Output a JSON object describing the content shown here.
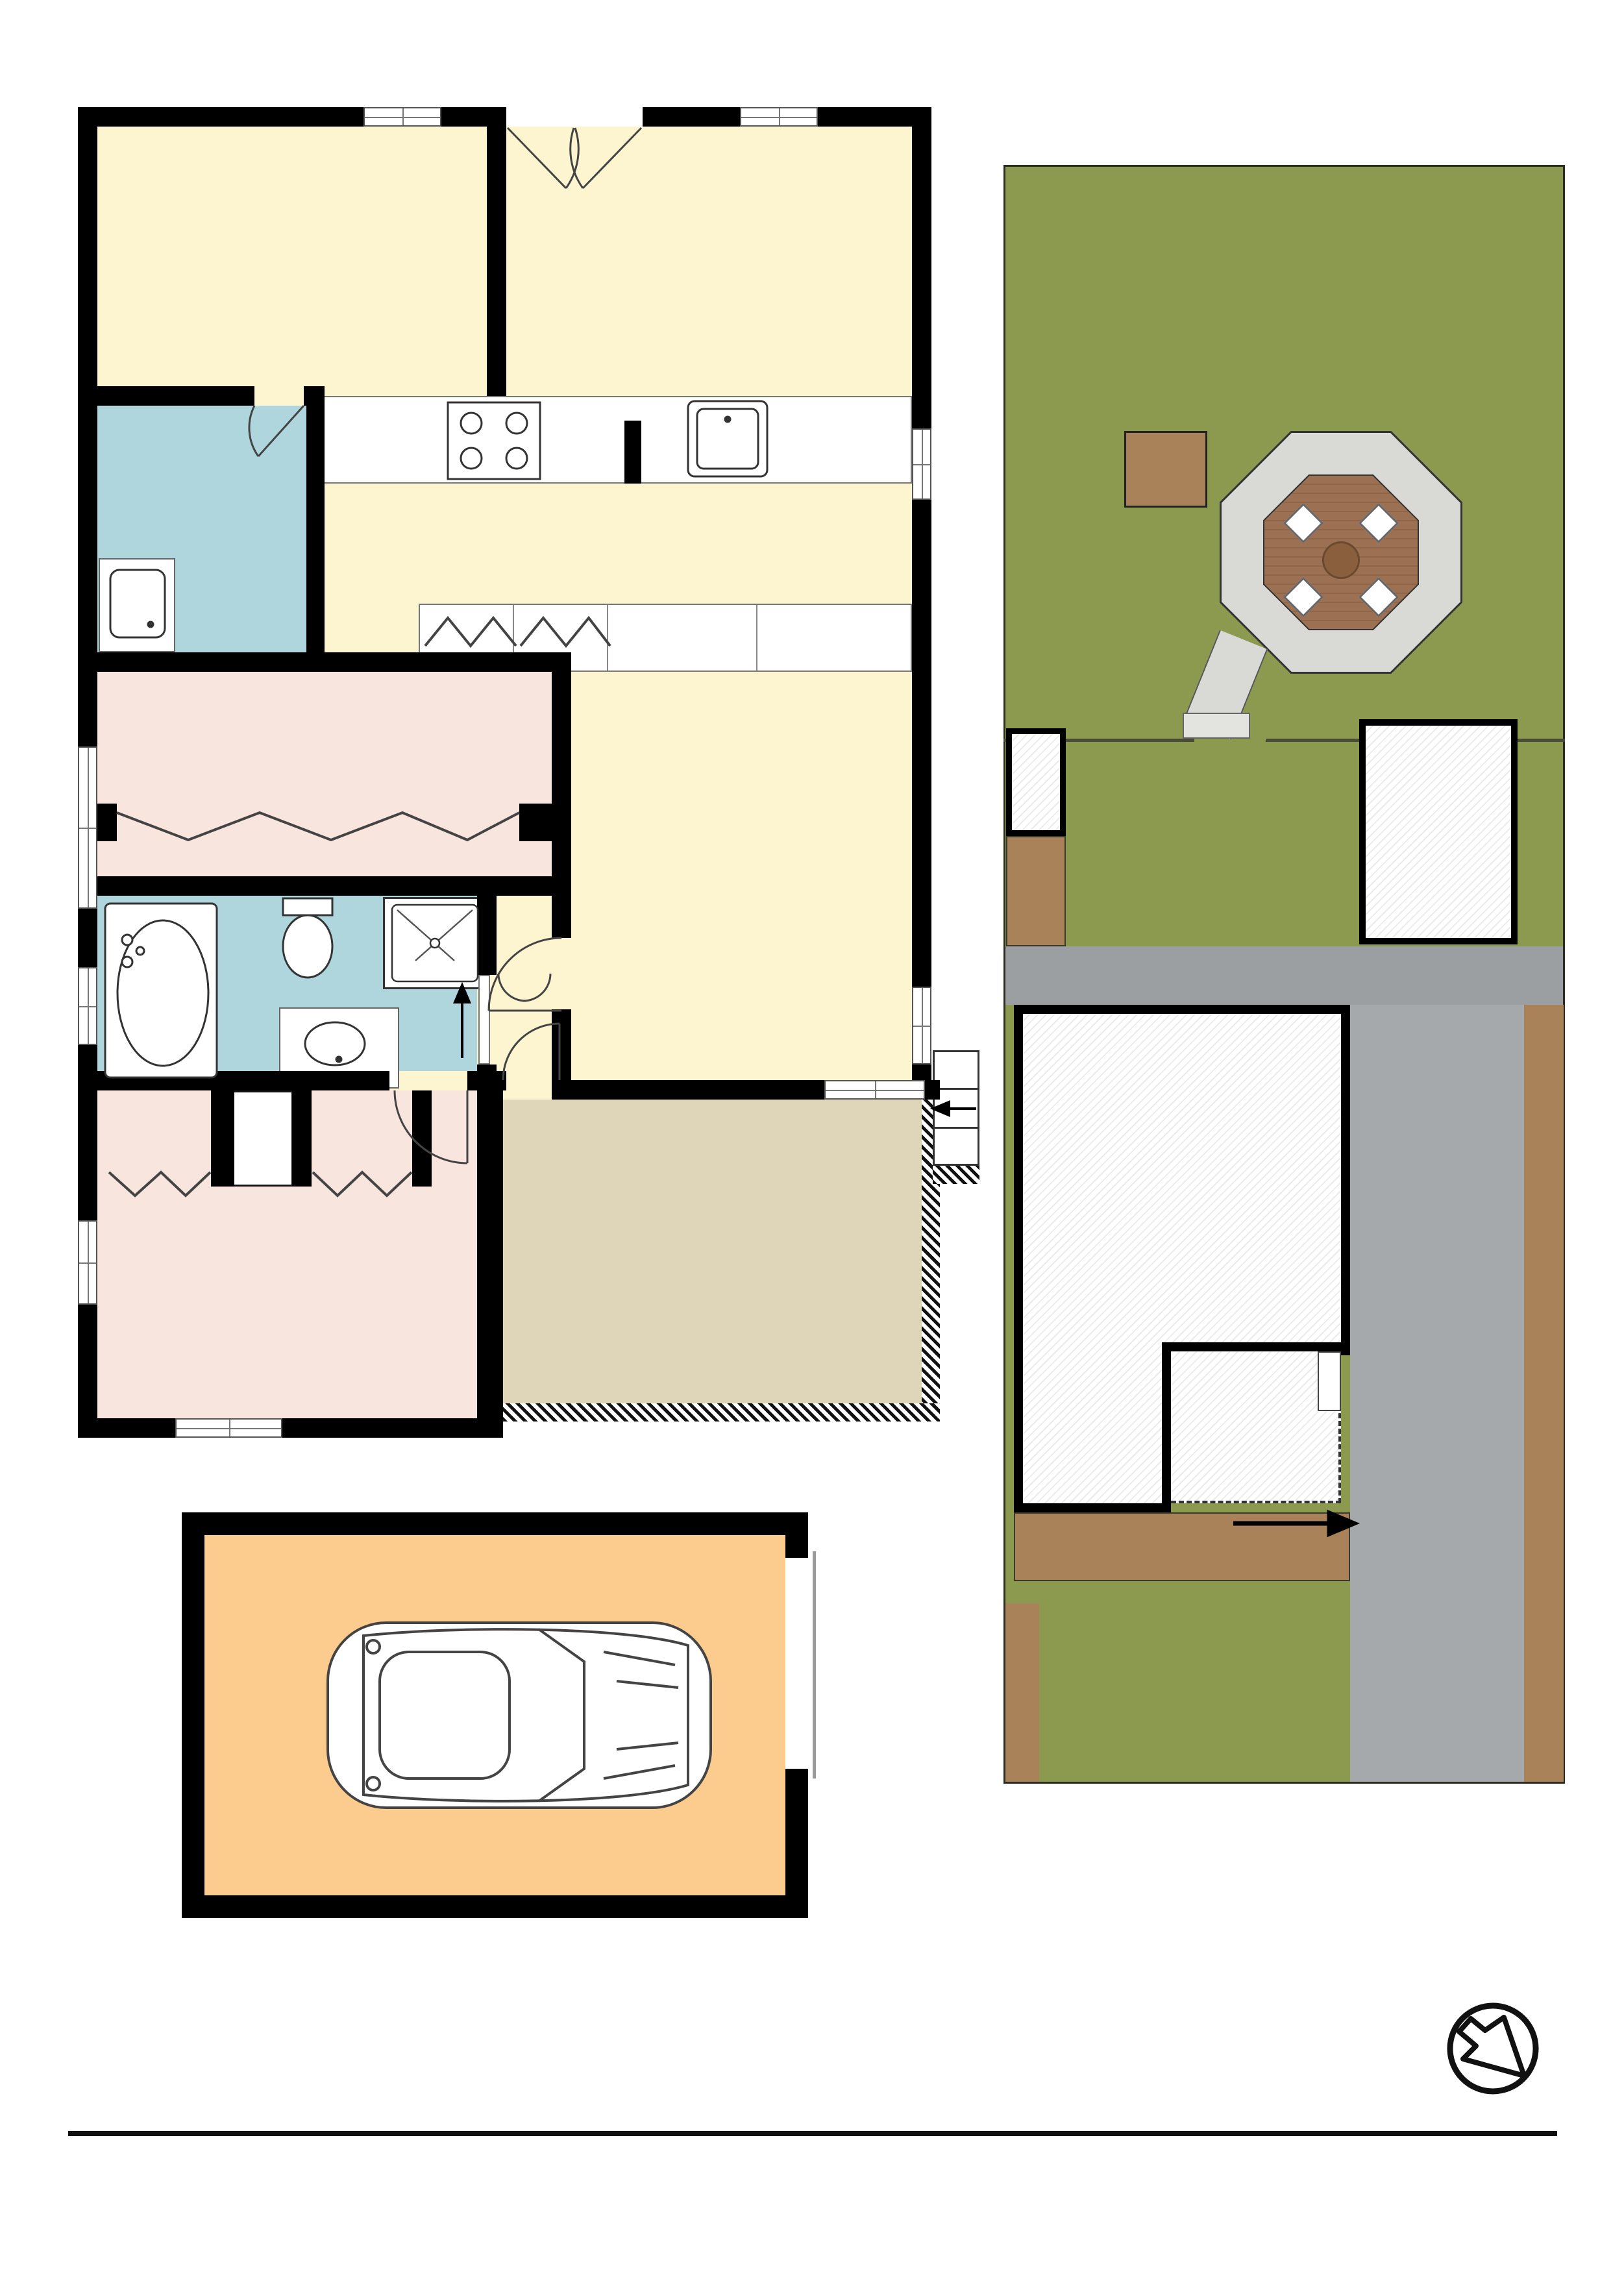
{
  "floor_plan": {
    "rooms": {
      "study": {
        "name": "STUDY",
        "dims": "4.0 x 2.7m"
      },
      "dining": {
        "name": "DINING",
        "dims": "4.5 x 2.7m"
      },
      "laundry": {
        "name": "L'DRY"
      },
      "kitchen": {
        "name": "KITCHEN",
        "dims": "4.0 x 2.5m"
      },
      "bed2": {
        "name": "BED 2",
        "dims": "3.7 x 3.0m"
      },
      "robe": {
        "name": "ROBE"
      },
      "bath": {
        "name": "BATH"
      },
      "closet": {
        "name": "C"
      },
      "entry": {
        "name": "ENTRY"
      },
      "living": {
        "name": "LIVING",
        "dims": "3.6 x 7.2m"
      },
      "bed1": {
        "name": "BED 1",
        "dims": "3.7 x 4.0m"
      },
      "patio": {
        "name": "PATIO",
        "dims": "5.0 x 4.0m"
      },
      "garage": {
        "name": "GARAGE",
        "dims": "6.0 x 4.0m"
      }
    },
    "cabinets": {
      "p1": "P",
      "p2": "P",
      "f": "F"
    },
    "robes": {
      "r1": "R",
      "r2": "R"
    }
  },
  "site_plan": {
    "labels": {
      "pergola": "PERGOLA",
      "shed": "SHED",
      "garage": "GARAGE",
      "residence": "RESIDENCE",
      "patio": "PATIO",
      "driveway": "DRIVEWAY"
    },
    "caption": {
      "line1": "SITE PLAN",
      "line2": "(NOT TO SCALE)"
    }
  },
  "footer": {
    "address": "39 Alick Street, Cabramatta",
    "disclaimer_label": "DISCLAIMER:",
    "disclaimer_text": "No liability for the accuracy of details contained within our floor plans. All plans are drawn and also checked to the best of our ability, however information contained in our floor plans such as area calculations are approximate, and have not been surveyed or drawn to scale. Our floor plans are for representational purposes only and should be used as such. Do not attempt to refer to our floor plans for structural or detailed information."
  },
  "colors": {
    "room_yellow": "#FCF5CF",
    "room_pink": "#F7E5DE",
    "room_blue": "#AFD6DD",
    "patio_tan": "#DFD5B8",
    "garage_orange": "#FBCC8E",
    "grass": "#8B9A4F",
    "dirt": "#A9825A",
    "driveway": "#A6A9AC",
    "wood": "#9C7052",
    "gravel": "#D9D9D5"
  }
}
